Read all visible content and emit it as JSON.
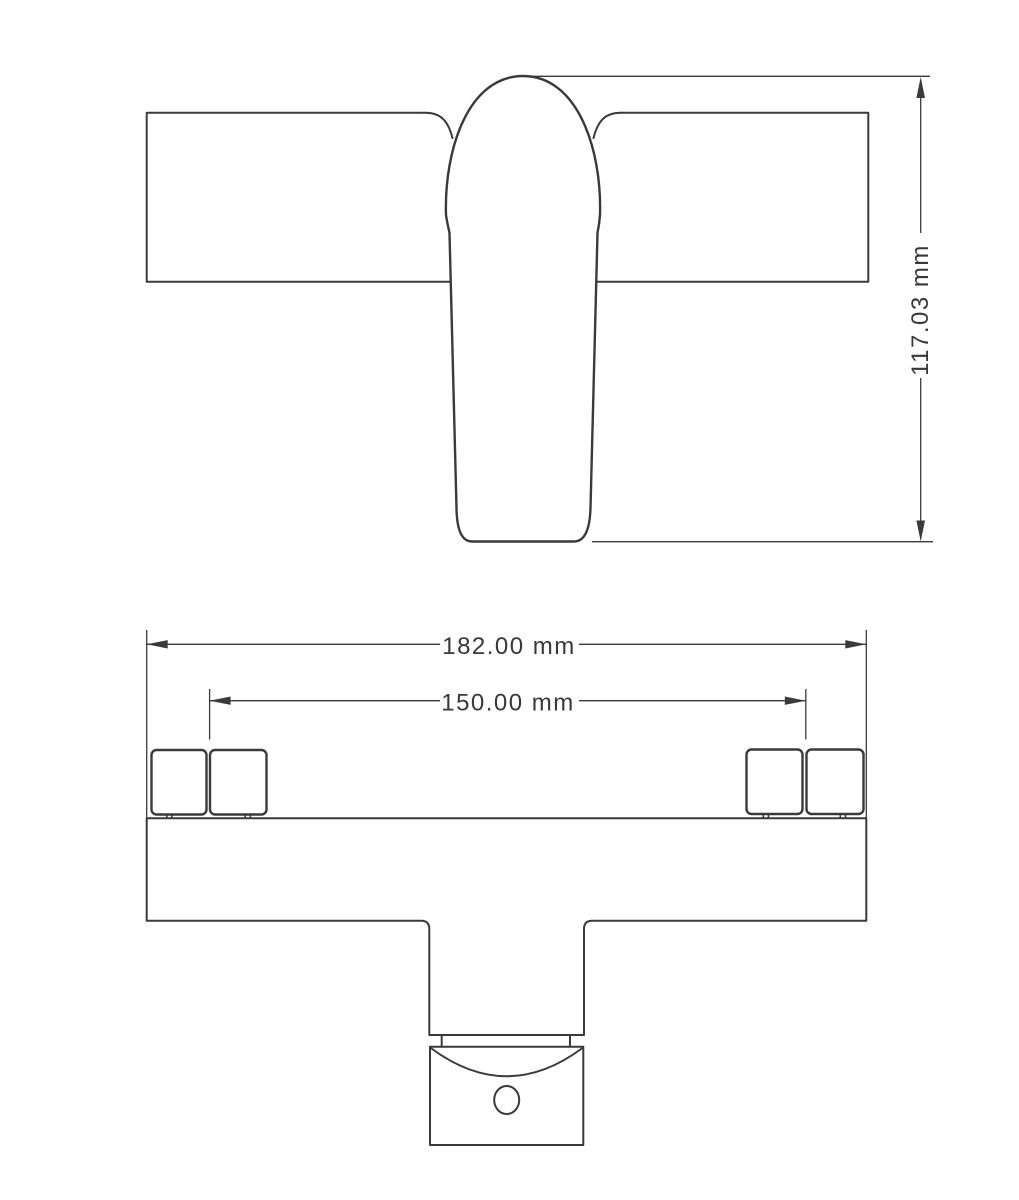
{
  "drawing": {
    "background_color": "#ffffff",
    "line_color": "#3a3a3a",
    "text_color": "#383838",
    "unit": "mm",
    "dimensions": {
      "overall_height": {
        "label": "117.03 mm",
        "value": 117.03,
        "unit": "mm"
      },
      "overall_width": {
        "label": "182.00 mm",
        "value": 182.0,
        "unit": "mm"
      },
      "inlet_spacing": {
        "label": "150.00 mm",
        "value": 150.0,
        "unit": "mm"
      }
    }
  }
}
